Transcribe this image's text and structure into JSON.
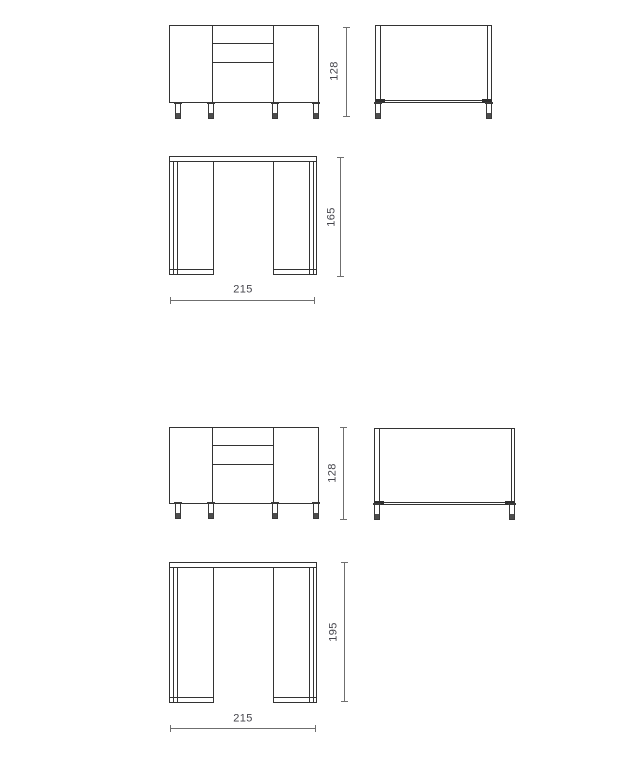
{
  "diagram": {
    "kind": "furniture-technical-drawing",
    "figures": [
      {
        "front_height": "128",
        "plan_depth": "165",
        "plan_width": "215"
      },
      {
        "front_height": "128",
        "plan_depth": "195",
        "plan_width": "215"
      }
    ],
    "colors": {
      "line": "#333333",
      "dimension_line": "#6f6f6f",
      "label_text": "#45454c",
      "foot_fill": "#4d4d4d",
      "background": "#ffffff"
    }
  }
}
